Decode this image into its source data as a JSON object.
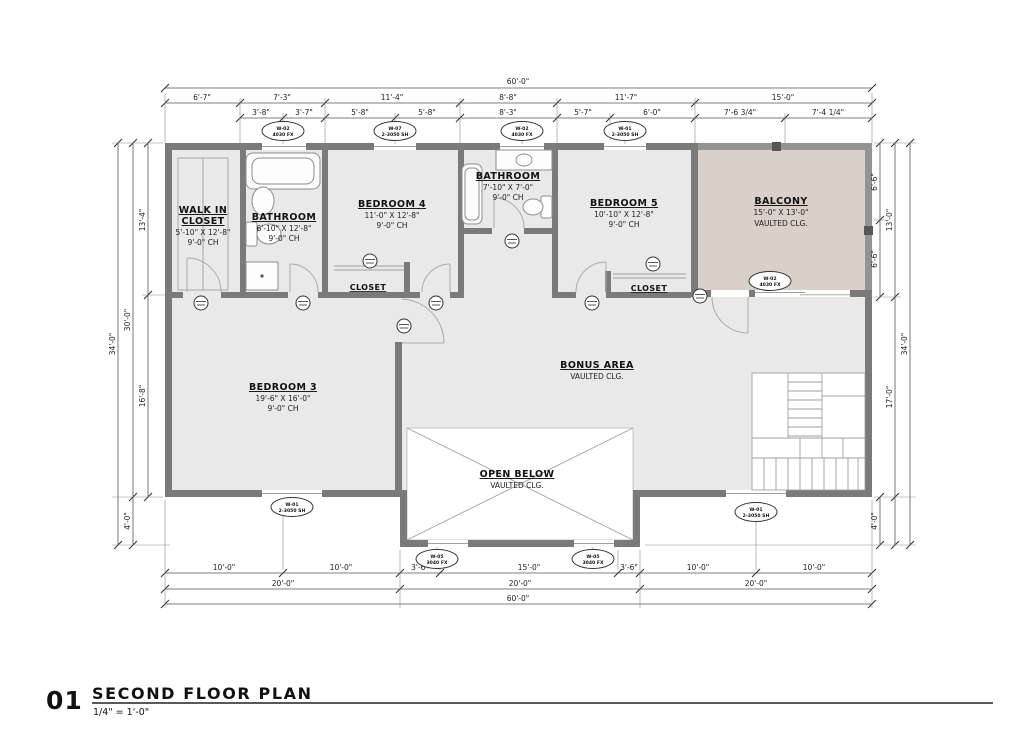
{
  "title_block": {
    "number": "01",
    "title": "SECOND FLOOR PLAN",
    "scale": "1/4\" = 1'-0\""
  },
  "rooms": {
    "walkin": {
      "name": "WALK IN",
      "name2": "CLOSET",
      "size": "5'-10\" X 12'-8\"",
      "ch": "9'-0\" CH"
    },
    "bath1": {
      "name": "BATHROOM",
      "size": "6'-10\" X 12'-8\"",
      "ch": "9'-0\" CH"
    },
    "bed4": {
      "name": "BEDROOM 4",
      "size": "11'-0\" X 12'-8\"",
      "ch": "9'-0\" CH"
    },
    "bath2": {
      "name": "BATHROOM",
      "size": "7'-10\" X 7'-0\"",
      "ch": "9'-0\" CH"
    },
    "bed5": {
      "name": "BEDROOM 5",
      "size": "10'-10\" X 12'-8\"",
      "ch": "9'-0\" CH"
    },
    "balcony": {
      "name": "BALCONY",
      "size": "15'-0\" X 13'-0\"",
      "ch": "VAULTED CLG."
    },
    "bed3": {
      "name": "BEDROOM 3",
      "size": "19'-6\" X 16'-0\"",
      "ch": "9'-0\" CH"
    },
    "bonus": {
      "name": "BONUS AREA",
      "ch": "VAULTED CLG."
    },
    "open": {
      "name": "OPEN BELOW",
      "ch": "VAULTED CLG."
    },
    "closet4": {
      "name": "CLOSET"
    },
    "closet5": {
      "name": "CLOSET"
    }
  },
  "dims": {
    "top_overall": "60'-0\"",
    "top_row": [
      "6'-7\"",
      "7'-3\"",
      "11'-4\"",
      "8'-8\"",
      "11'-7\"",
      "15'-0\""
    ],
    "top_sub": [
      "3'-8\"",
      "3'-7\"",
      "5'-8\"",
      "5'-8\"",
      "8'-3\"",
      "5'-7\"",
      "6'-0\"",
      "7'-6 3/4\"",
      "7'-4 1/4\""
    ],
    "left": {
      "overall": "34'-0\"",
      "upper": "30'-0\"",
      "lower": "4'-0\"",
      "seg1": "13'-4\"",
      "seg2": "16'-8\""
    },
    "right": {
      "overall": "34'-0\"",
      "balcony": "13'-0\"",
      "bonus": "17'-0\"",
      "lower": "4'-0\"",
      "half1": "6'-6\"",
      "half2": "6'-6\""
    },
    "bottom_row": [
      "10'-0\"",
      "10'-0\"",
      "3'-6\"",
      "15'-0\"",
      "3'-6\"",
      "10'-0\"",
      "10'-0\""
    ],
    "bottom_20": [
      "20'-0\"",
      "20'-0\"",
      "20'-0\""
    ],
    "bottom_overall": "60'-0\""
  },
  "tags": {
    "window": [
      {
        "id": "W-02",
        "size": "4030 FX"
      },
      {
        "id": "W-07",
        "size": "2-3050 SH"
      },
      {
        "id": "W-02",
        "size": "4030 FX"
      },
      {
        "id": "W-01",
        "size": "2-3050 SH"
      },
      {
        "id": "W-02",
        "size": "4030 FX"
      },
      {
        "id": "W-01",
        "size": "2-3050 SH"
      },
      {
        "id": "W-05",
        "size": "3040 FX"
      },
      {
        "id": "W-05",
        "size": "3040 FX"
      },
      {
        "id": "W-01",
        "size": "2-3050 SH"
      }
    ]
  }
}
